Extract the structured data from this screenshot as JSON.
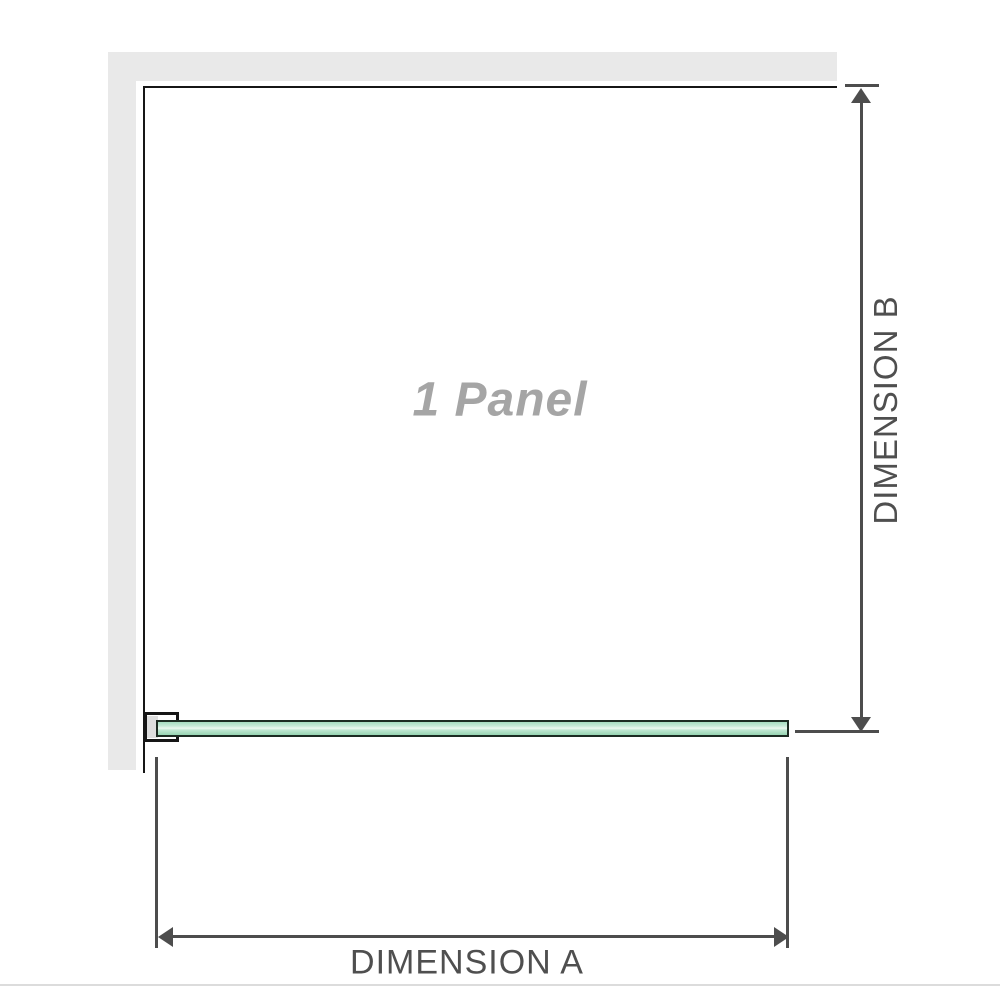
{
  "labels": {
    "panel": "1 Panel",
    "dimension_a": "DIMENSION A",
    "dimension_b": "DIMENSION B"
  },
  "colors": {
    "wall_fill": "#e9e9e9",
    "wall_edge": "#161616",
    "clamp_outline": "#161616",
    "clamp_channel": "#dedede",
    "glass_fill": "#a5dcc0",
    "glass_highlight": "#ecf8f1",
    "glass_border": "#1c2b22",
    "dim_line": "#4d4d4d",
    "dim_text": "#4f4f4f",
    "panel_text": "#a5a5a5",
    "bottom_rule": "#dcdcdc"
  }
}
